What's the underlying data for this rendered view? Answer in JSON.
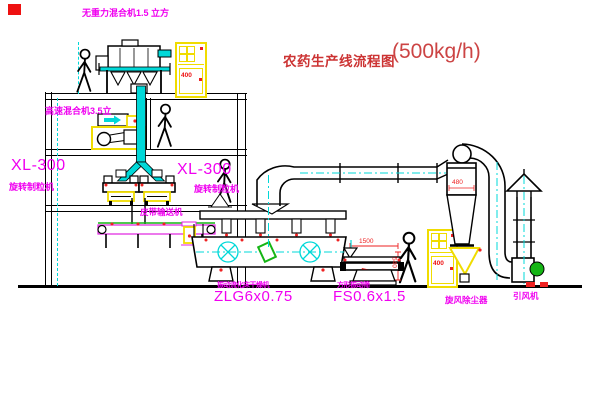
{
  "diagram": {
    "title": "农药生产线流程图",
    "capacity": "(500kg/h)"
  },
  "labels": {
    "gravity_free_mixer": "无重力混合机1.5 立方",
    "high_speed_mixer": "高速混合机3.5立",
    "granulator_left_model": "XL-300",
    "granulator_left_name": "旋转制粒机",
    "granulator_center_model": "XL-300",
    "granulator_center_name": "旋转制粒机",
    "belt_conveyor": "皮带输送机",
    "dryer_name": "振动流化床干燥机",
    "dryer_model": "ZLG6x0.75",
    "screen_name": "方形振动筛",
    "screen_model": "FS0.6x1.5",
    "cyclone": "旋风除尘器",
    "fan": "引风机"
  },
  "dimensions": {
    "screen_length": "1500",
    "screen_height": "540",
    "cyclone_width": "480"
  },
  "cabinets": {
    "marking": "400"
  },
  "colors": {
    "label_magenta": "#f000f0",
    "title_red": "#cc3333",
    "equipment_yellow": "#f0dc00",
    "centerline_cyan": "#00d8d8",
    "accent_red": "#ee2222",
    "accent_green": "#15b515",
    "line_black": "#000000"
  }
}
